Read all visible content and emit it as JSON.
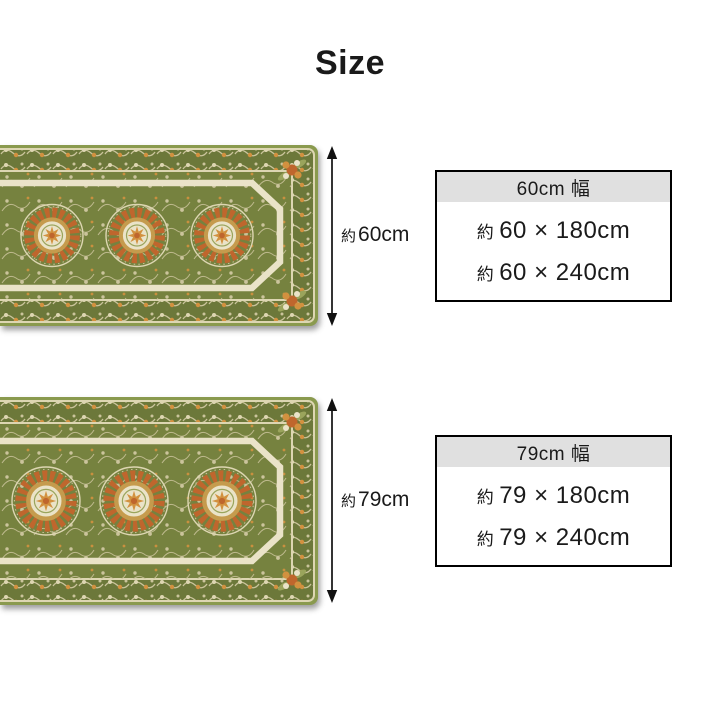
{
  "page": {
    "title": "Size"
  },
  "products": [
    {
      "id": "60cm",
      "image_name": "ornate-green-kitchen-mat",
      "height_label": {
        "prefix": "約",
        "value": "60cm"
      },
      "size_box": {
        "header": "60cm 幅",
        "rows": [
          {
            "prefix": "約",
            "dims": "60 × 180cm"
          },
          {
            "prefix": "約",
            "dims": "60 × 240cm"
          }
        ]
      }
    },
    {
      "id": "79cm",
      "image_name": "ornate-green-kitchen-mat",
      "height_label": {
        "prefix": "約",
        "value": "79cm"
      },
      "size_box": {
        "header": "79cm 幅",
        "rows": [
          {
            "prefix": "約",
            "dims": "79 × 180cm"
          },
          {
            "prefix": "約",
            "dims": "79 × 240cm"
          }
        ]
      }
    }
  ],
  "colors": {
    "text": "#1a1a1a",
    "arrow": "#111111",
    "box_border": "#000000",
    "box_header_bg": "#e0e0e0",
    "rug_edge_green": "#8a9a4e",
    "rug_band_green": "#6c783a",
    "rug_field_green": "#76823f",
    "rug_cream": "#ddd6b2",
    "rug_cream_dim": "#cbc49c",
    "rug_cream_light": "#eae3c8",
    "rug_gold": "#c59b4d",
    "rug_orange": "#bf662d",
    "rug_orange_light": "#d2913f",
    "rug_leaf_green": "#9aa45c"
  }
}
